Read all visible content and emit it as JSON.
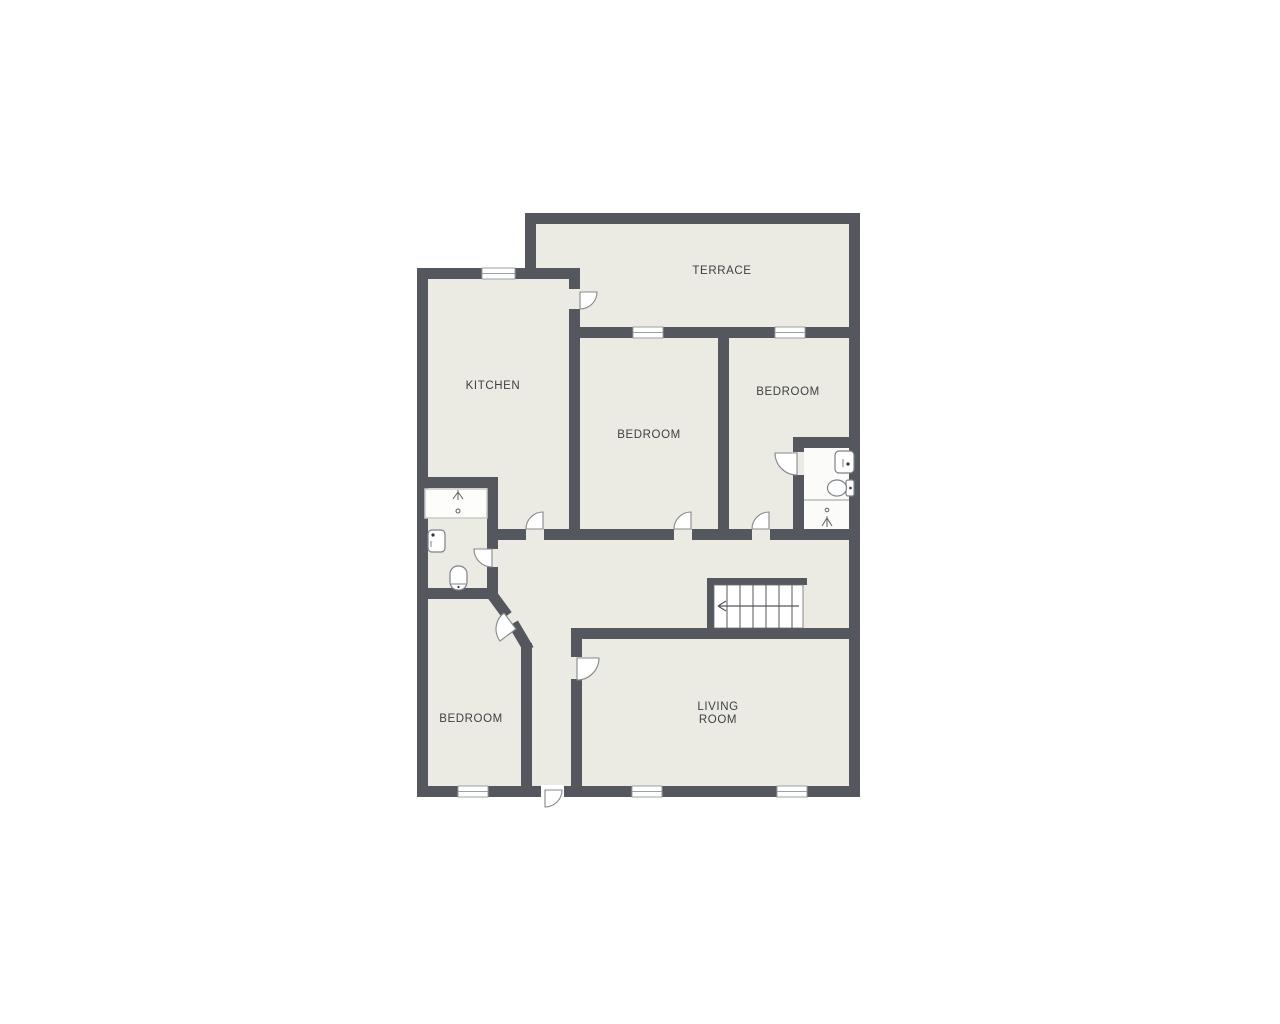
{
  "page": {
    "type": "floor-plan",
    "background": "#ffffff"
  },
  "colors": {
    "wall": "#54575e",
    "floor": "#ebeae3",
    "bathroom_floor": "#fbfbf9",
    "window_fill": "#ffffff",
    "label_text": "#3e4144",
    "fixture_outline": "#7d8287"
  },
  "rooms": [
    {
      "id": "terrace",
      "label": "TERRACE"
    },
    {
      "id": "kitchen",
      "label": "KITCHEN"
    },
    {
      "id": "bedroom-top-center",
      "label": "BEDROOM"
    },
    {
      "id": "bedroom-top-right",
      "label": "BEDROOM"
    },
    {
      "id": "bedroom-bottom-left",
      "label": "BEDROOM"
    },
    {
      "id": "living-room",
      "label": "LIVING ROOM",
      "lines": [
        "LIVING",
        "ROOM"
      ]
    }
  ],
  "doors": [
    {
      "id": "kitchen-terrace-door"
    },
    {
      "id": "hall-kitchen-door"
    },
    {
      "id": "hall-bedroom-center-door"
    },
    {
      "id": "hall-bedroom-right-door"
    },
    {
      "id": "bedroom-bathroom-right-door"
    },
    {
      "id": "hall-bathroom-left-door"
    },
    {
      "id": "hall-bedroom-bottom-door"
    },
    {
      "id": "hall-living-room-door"
    },
    {
      "id": "entrance-door"
    }
  ],
  "windows_count": 6,
  "stairs": {
    "treads": 7,
    "arrow_direction": "left"
  },
  "fixtures": {
    "left_bathroom": [
      "shower",
      "sink",
      "toilet"
    ],
    "right_bathroom": [
      "sink",
      "toilet",
      "shower"
    ]
  }
}
